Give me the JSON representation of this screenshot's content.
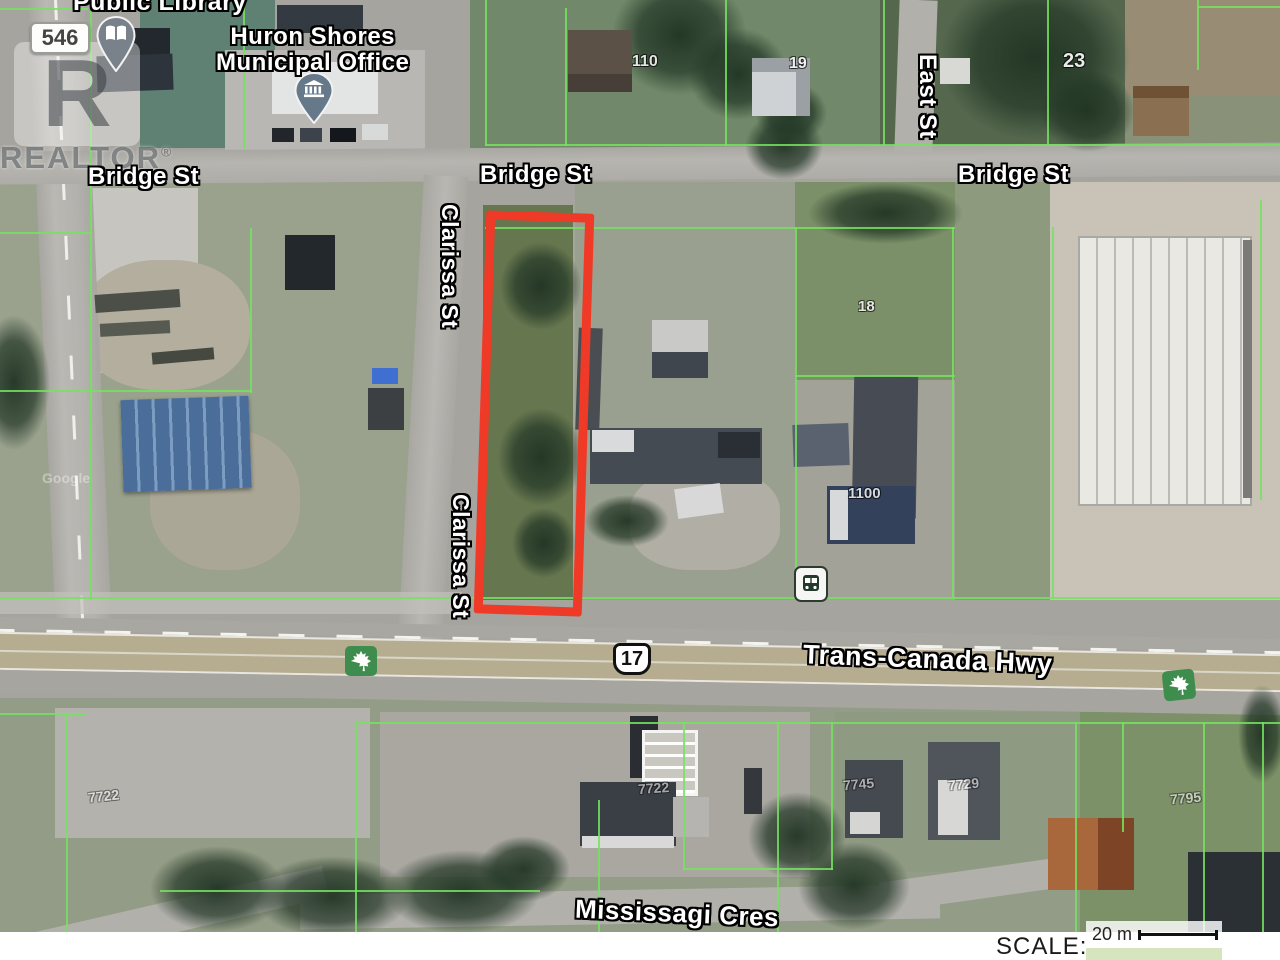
{
  "watermark": {
    "logo_letter": "R",
    "brand": "REALTOR",
    "registered": "®"
  },
  "credit": {
    "imagery": "Google"
  },
  "badges": {
    "route_546": "546",
    "route_17": "17"
  },
  "pois": {
    "public_library": "Public Library",
    "municipal_office_line1": "Huron Shores",
    "municipal_office_line2": "Municipal Office"
  },
  "streets": {
    "bridge_left": "Bridge St",
    "bridge_center": "Bridge St",
    "bridge_right": "Bridge St",
    "clarissa_upper": "Clarissa St",
    "clarissa_lower": "Clarissa St",
    "east": "East St",
    "trans_canada": "Trans-Canada Hwy",
    "mississagi": "Mississagi Cres"
  },
  "house_numbers": {
    "n110": "110",
    "n19": "19",
    "n23": "23",
    "n18": "18",
    "n1100": "1100",
    "n7722_left": "7722",
    "n7722": "7722",
    "n7745": "7745",
    "n7729": "7729",
    "n7795": "7795"
  },
  "scale": {
    "label": "SCALE:",
    "value": "20 m"
  },
  "colors": {
    "parcel_line": "#74e35f",
    "highlight_outline": "#ee3a26",
    "maple_leaf_bg": "#3f8d4e",
    "library_pin": "#79818a",
    "municipal_pin": "#66798b",
    "highway_lane": "#b6ad90"
  }
}
